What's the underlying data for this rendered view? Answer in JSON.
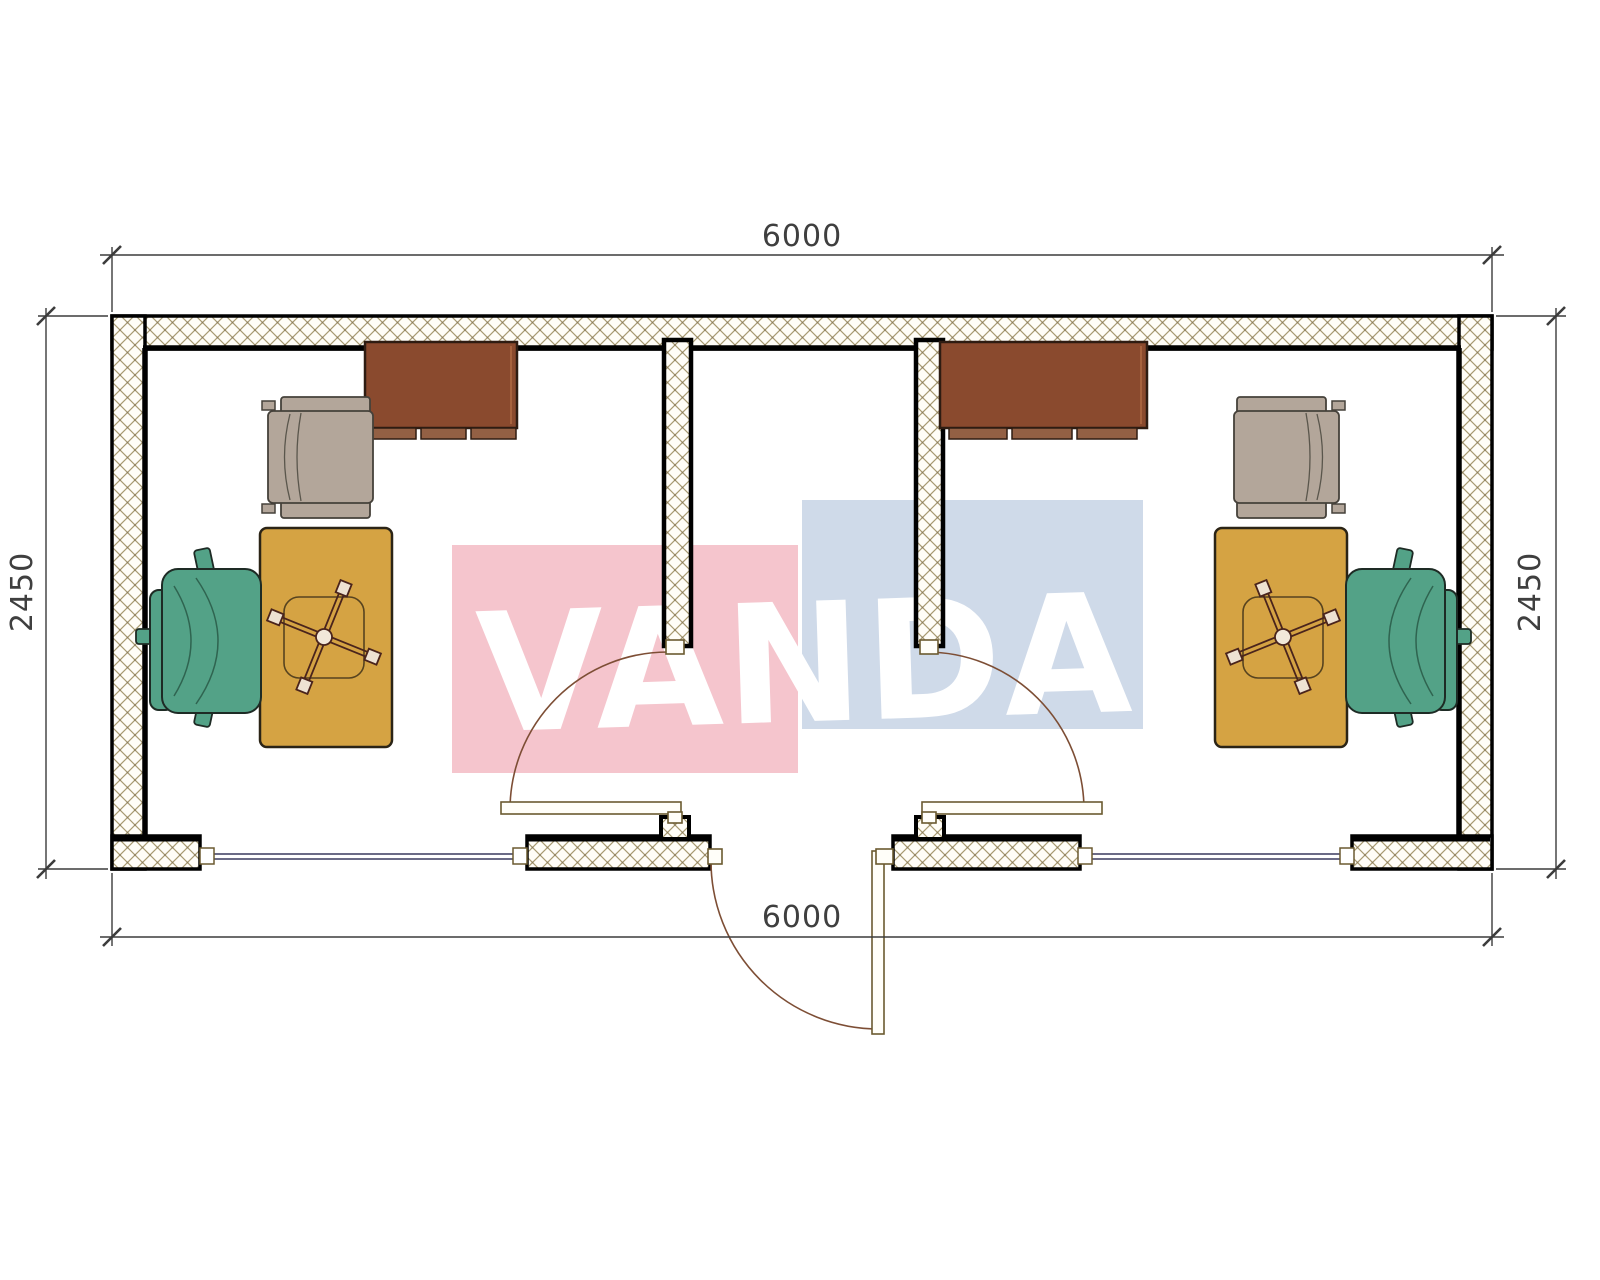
{
  "watermark": {
    "text": "VANDA",
    "text_color": "#ffffff",
    "pink_block_color": "#f5c5cd",
    "blue_block_color": "#cfdae9"
  },
  "dimensions": {
    "top_width": "6000",
    "bottom_width": "6000",
    "left_height": "2450",
    "right_height": "2450"
  },
  "plan": {
    "type": "floor-plan",
    "building": "two-room office container with central entrance vestibule",
    "rooms": [
      "left-office",
      "vestibule",
      "right-office"
    ],
    "furniture_per_office": [
      "wall-cabinet",
      "armchair",
      "desk",
      "task-chair-base",
      "office-chair"
    ],
    "openings": [
      "left-window",
      "entrance-door",
      "right-window",
      "left-room-door",
      "right-room-door"
    ],
    "colors": {
      "wall_hatch": "#a89a72",
      "wall_outline": "#000000",
      "window_line": "#3a3a5e",
      "door_line": "#7d4e35",
      "desk": "#d5a343",
      "office_chair_green": "#53a287",
      "armchair_taupe": "#b3a69a",
      "cabinet_brown": "#8a4a2e",
      "dimension_text": "#3f3f3f"
    }
  }
}
